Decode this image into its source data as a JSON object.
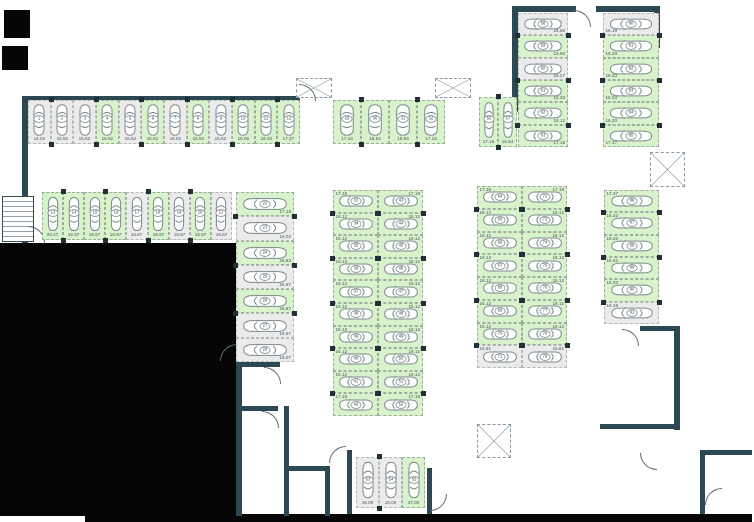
{
  "colors": {
    "available": "#d8f3cb",
    "occupied": "#ebebeb",
    "wall": "#2b4853",
    "pillar": "#1f3038",
    "car_outline": "#7e888d",
    "label_text": "#45555c"
  },
  "groups": {
    "rowA": {
      "spaces": [
        {
          "num": "1",
          "size": "14.04",
          "status": "occupied"
        },
        {
          "num": "2",
          "size": "15.52",
          "status": "occupied"
        },
        {
          "num": "3",
          "size": "15.52",
          "status": "occupied"
        },
        {
          "num": "4",
          "size": "15.52",
          "status": "available"
        },
        {
          "num": "5",
          "size": "15.52",
          "status": "occupied"
        },
        {
          "num": "6",
          "size": "15.52",
          "status": "available"
        },
        {
          "num": "7",
          "size": "15.52",
          "status": "occupied"
        },
        {
          "num": "8",
          "size": "15.52",
          "status": "available"
        },
        {
          "num": "9",
          "size": "15.52",
          "status": "occupied"
        },
        {
          "num": "10",
          "size": "16.06",
          "status": "available"
        },
        {
          "num": "11",
          "size": "16.33",
          "status": "available"
        },
        {
          "num": "12",
          "size": "17.37",
          "status": "available"
        }
      ]
    },
    "rowB": {
      "spaces": [
        {
          "num": "13",
          "size": "20.27",
          "status": "available"
        },
        {
          "num": "14",
          "size": "16.67",
          "status": "available"
        },
        {
          "num": "15",
          "size": "16.67",
          "status": "available"
        },
        {
          "num": "16",
          "size": "16.67",
          "status": "available"
        },
        {
          "num": "17",
          "size": "16.67",
          "status": "occupied"
        },
        {
          "num": "18",
          "size": "16.67",
          "status": "available"
        },
        {
          "num": "19",
          "size": "16.67",
          "status": "occupied"
        },
        {
          "num": "20",
          "size": "16.67",
          "status": "available"
        },
        {
          "num": "21",
          "size": "16.67",
          "status": "occupied"
        }
      ]
    },
    "colC": {
      "spaces": [
        {
          "num": "22",
          "size": "17.18",
          "status": "available"
        },
        {
          "num": "23",
          "size": "16.02",
          "status": "occupied"
        },
        {
          "num": "24",
          "size": "16.63",
          "status": "available"
        },
        {
          "num": "25",
          "size": "16.67",
          "status": "occupied"
        },
        {
          "num": "26",
          "size": "16.67",
          "status": "available"
        },
        {
          "num": "27",
          "size": "16.67",
          "status": "occupied"
        },
        {
          "num": "28",
          "size": "16.07",
          "status": "occupied"
        }
      ]
    },
    "rowD": {
      "spaces": [
        {
          "num": "29",
          "size": "17.16",
          "status": "available"
        },
        {
          "num": "30",
          "size": "16.54",
          "status": "available"
        },
        {
          "num": "31",
          "size": "16.54",
          "status": "available"
        },
        {
          "num": "32",
          "size": "17.16",
          "status": "available"
        }
      ]
    },
    "colE": {
      "spaces": [
        {
          "num": "33",
          "size": "17.18",
          "status": "available"
        },
        {
          "num": "34",
          "size": "16.12",
          "status": "available"
        },
        {
          "num": "35",
          "size": "16.12",
          "status": "available"
        },
        {
          "num": "36",
          "size": "16.12",
          "status": "available"
        },
        {
          "num": "37",
          "size": "16.12",
          "status": "available"
        },
        {
          "num": "38",
          "size": "16.12",
          "status": "available"
        },
        {
          "num": "39",
          "size": "16.12",
          "status": "available"
        },
        {
          "num": "40",
          "size": "16.12",
          "status": "available"
        },
        {
          "num": "41",
          "size": "16.12",
          "status": "available"
        },
        {
          "num": "42",
          "size": "17.18",
          "status": "available"
        }
      ]
    },
    "colF": {
      "spaces": [
        {
          "num": "43",
          "size": "17.18",
          "status": "available"
        },
        {
          "num": "44",
          "size": "16.12",
          "status": "available"
        },
        {
          "num": "45",
          "size": "16.12",
          "status": "available"
        },
        {
          "num": "46",
          "size": "16.12",
          "status": "available"
        },
        {
          "num": "47",
          "size": "16.12",
          "status": "available"
        },
        {
          "num": "48",
          "size": "16.12",
          "status": "available"
        },
        {
          "num": "49",
          "size": "16.12",
          "status": "available"
        },
        {
          "num": "50",
          "size": "16.12",
          "status": "available"
        },
        {
          "num": "51",
          "size": "16.12",
          "status": "available"
        },
        {
          "num": "52",
          "size": "17.18",
          "status": "available"
        }
      ]
    },
    "pairG": {
      "spaces": [
        {
          "num": "56",
          "size": "17.16",
          "status": "available"
        },
        {
          "num": "57",
          "size": "16.54",
          "status": "available"
        }
      ]
    },
    "colH": {
      "spaces": [
        {
          "num": "58",
          "size": "16.65",
          "status": "occupied"
        },
        {
          "num": "59",
          "size": "16.66",
          "status": "available"
        },
        {
          "num": "60",
          "size": "16.27",
          "status": "occupied"
        },
        {
          "num": "61",
          "size": "16.33",
          "status": "available"
        },
        {
          "num": "62",
          "size": "16.12",
          "status": "available"
        },
        {
          "num": "63",
          "size": "17.18",
          "status": "available"
        }
      ]
    },
    "colI": {
      "spaces": [
        {
          "num": "80",
          "size": "16.19",
          "status": "occupied"
        },
        {
          "num": "81",
          "size": "16.33",
          "status": "available"
        },
        {
          "num": "82",
          "size": "16.33",
          "status": "available"
        },
        {
          "num": "83",
          "size": "16.33",
          "status": "available"
        },
        {
          "num": "84",
          "size": "16.33",
          "status": "available"
        },
        {
          "num": "85",
          "size": "17.37",
          "status": "available"
        }
      ]
    },
    "colJ": {
      "spaces": [
        {
          "num": "64",
          "size": "17.18",
          "status": "available"
        },
        {
          "num": "65",
          "size": "16.12",
          "status": "available"
        },
        {
          "num": "66",
          "size": "16.12",
          "status": "available"
        },
        {
          "num": "67",
          "size": "16.12",
          "status": "available"
        },
        {
          "num": "68",
          "size": "16.12",
          "status": "available"
        },
        {
          "num": "69",
          "size": "16.12",
          "status": "available"
        },
        {
          "num": "70",
          "size": "16.12",
          "status": "available"
        },
        {
          "num": "71",
          "size": "16.81",
          "status": "occupied"
        }
      ]
    },
    "colK": {
      "spaces": [
        {
          "num": "72",
          "size": "17.18",
          "status": "available"
        },
        {
          "num": "73",
          "size": "16.12",
          "status": "available"
        },
        {
          "num": "74",
          "size": "16.12",
          "status": "available"
        },
        {
          "num": "75",
          "size": "16.12",
          "status": "available"
        },
        {
          "num": "76",
          "size": "16.12",
          "status": "available"
        },
        {
          "num": "77",
          "size": "16.12",
          "status": "available"
        },
        {
          "num": "78",
          "size": "16.12",
          "status": "available"
        },
        {
          "num": "79",
          "size": "16.81",
          "status": "occupied"
        }
      ]
    },
    "colL": {
      "spaces": [
        {
          "num": "86",
          "size": "17.37",
          "status": "available"
        },
        {
          "num": "87",
          "size": "16.33",
          "status": "available"
        },
        {
          "num": "88",
          "size": "16.33",
          "status": "available"
        },
        {
          "num": "89",
          "size": "16.33",
          "status": "available"
        },
        {
          "num": "90",
          "size": "16.33",
          "status": "available"
        },
        {
          "num": "91",
          "size": "16.19",
          "status": "occupied"
        }
      ]
    },
    "trioM": {
      "spaces": [
        {
          "num": "53",
          "size": "16.00",
          "status": "occupied"
        },
        {
          "num": "54",
          "size": "16.00",
          "status": "occupied"
        },
        {
          "num": "55",
          "size": "17.00",
          "status": "available"
        }
      ]
    }
  }
}
